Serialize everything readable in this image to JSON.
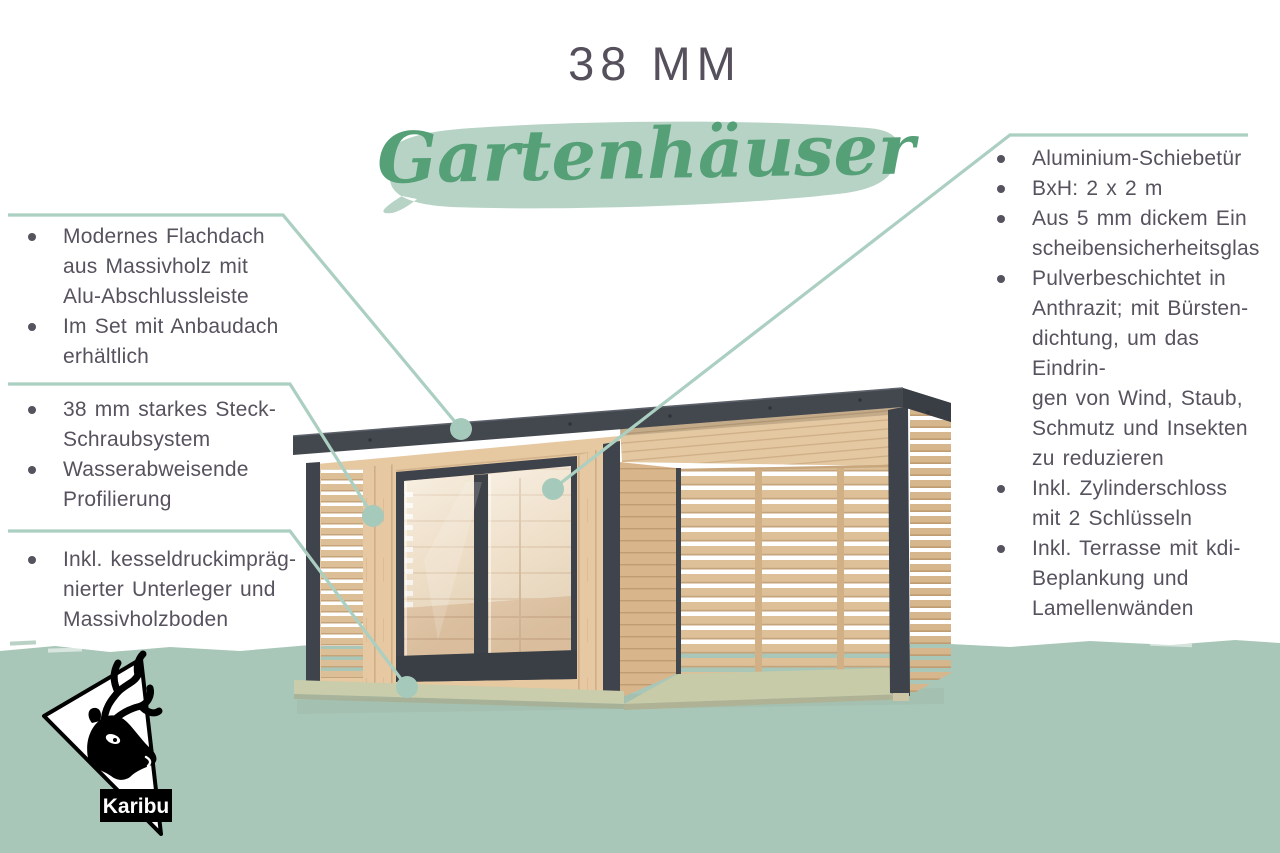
{
  "title": {
    "size_label": "38 MM",
    "category": "Gartenhäuser"
  },
  "callouts": {
    "left": [
      {
        "items": [
          "Modernes Flachdach\naus Massivholz mit\nAlu-Abschlussleiste",
          "Im Set mit Anbaudach\nerhältlich"
        ]
      },
      {
        "items": [
          "38 mm starkes Steck-\nSchraubsystem",
          "Wasserabweisende\nProfilierung"
        ]
      },
      {
        "items": [
          "Inkl. kesseldruckimpräg-\nnierter Unterleger und\nMassivholzboden"
        ]
      }
    ],
    "right": {
      "items": [
        "Aluminium-Schiebetür",
        "BxH: 2 x 2 m",
        "Aus 5 mm dickem Ein\nscheibensicherheitsglas",
        "Pulverbeschichtet in\nAnthrazit; mit Bürsten-\ndichtung, um das Eindrin-\ngen von Wind, Staub,\nSchmutz und Insekten\nzu reduzieren",
        "Inkl. Zylinderschloss\nmit 2 Schlüsseln",
        "Inkl. Terrasse mit kdi-\nBeplankung und\nLamellenwänden"
      ]
    }
  },
  "logo": {
    "brand": "Karibu"
  },
  "palette": {
    "accent_green": "#55a077",
    "brush_green": "#b6d3c5",
    "line_green": "#abcfc0",
    "ground_green": "#a9c7b8",
    "text_gray": "#56525e",
    "roof_anthracite": "#43474e",
    "wood_light": "#e6c8a1"
  }
}
